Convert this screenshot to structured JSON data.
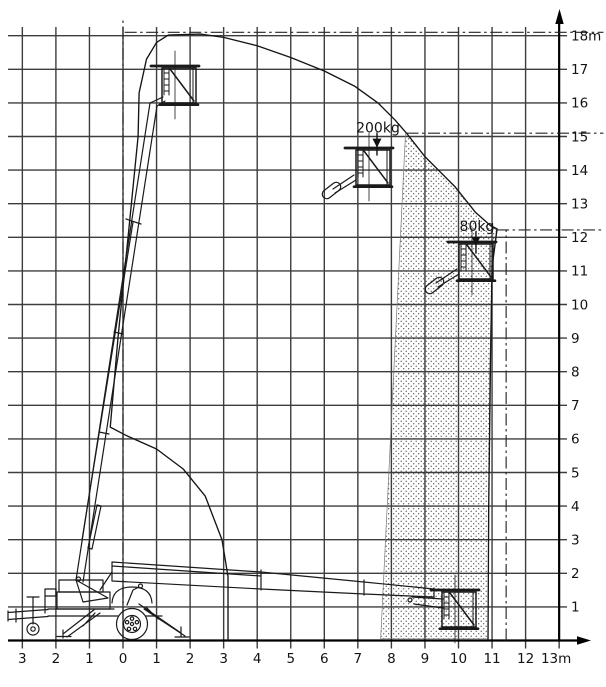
{
  "diagram": {
    "name": "aerial-work-platform-working-range-diagram",
    "x_axis": {
      "unit": "m",
      "values": [
        -3,
        -2,
        -1,
        0,
        1,
        2,
        3,
        4,
        5,
        6,
        7,
        8,
        9,
        10,
        11,
        12,
        13
      ],
      "labels": [
        "3",
        "2",
        "1",
        "0",
        "1",
        "2",
        "3",
        "4",
        "5",
        "6",
        "7",
        "8",
        "9",
        "10",
        "11",
        "12",
        "13m"
      ]
    },
    "y_axis": {
      "unit": "m",
      "values": [
        18,
        17,
        16,
        15,
        14,
        13,
        12,
        11,
        10,
        9,
        8,
        7,
        6,
        5,
        4,
        3,
        2,
        1
      ],
      "labels": [
        "18m",
        "17",
        "16",
        "15",
        "14",
        "13",
        "12",
        "11",
        "10",
        "9",
        "8",
        "7",
        "6",
        "5",
        "4",
        "3",
        "2",
        "1"
      ]
    },
    "load_limits": [
      {
        "label": "200kg",
        "x": 7.6,
        "text_y": 15.27,
        "arrow_top_y": 15.12,
        "arrow_tip_y": 14.67
      },
      {
        "label": "80kg",
        "x": 10.55,
        "text_y": 12.33,
        "arrow_top_y": 12.18,
        "arrow_tip_y": 11.75
      }
    ]
  },
  "chart_data": {
    "type": "area",
    "title": "Working envelope diagram with load limits (height m vs outreach m)",
    "xlim": [
      -3,
      13
    ],
    "ylim": [
      0,
      18
    ],
    "grid": "on",
    "envelope_m": [
      [
        3.13,
        0.02
      ],
      [
        3.13,
        1.9
      ],
      [
        2.95,
        3.0
      ],
      [
        2.45,
        4.3
      ],
      [
        1.8,
        5.1
      ],
      [
        1.0,
        5.7
      ],
      [
        0.1,
        6.1
      ],
      [
        -0.38,
        6.35
      ],
      [
        -0.15,
        9.0
      ],
      [
        0.15,
        12.0
      ],
      [
        0.35,
        14.0
      ],
      [
        0.45,
        15.0
      ],
      [
        0.48,
        16.3
      ],
      [
        0.7,
        17.3
      ],
      [
        1.0,
        17.8
      ],
      [
        1.35,
        18.02
      ],
      [
        2.3,
        18.05
      ],
      [
        3.0,
        17.95
      ],
      [
        4.0,
        17.7
      ],
      [
        5.0,
        17.35
      ],
      [
        6.0,
        16.95
      ],
      [
        6.9,
        16.5
      ],
      [
        7.6,
        16.0
      ],
      [
        8.1,
        15.5
      ],
      [
        8.45,
        15.1
      ],
      [
        9.0,
        14.4
      ],
      [
        9.5,
        13.9
      ],
      [
        9.9,
        13.5
      ],
      [
        10.5,
        12.75
      ],
      [
        10.95,
        12.35
      ],
      [
        11.15,
        12.25
      ],
      [
        11.0,
        11.1
      ],
      [
        10.95,
        8.0
      ],
      [
        10.9,
        4.0
      ],
      [
        10.88,
        0.05
      ]
    ],
    "restricted_zone_m": [
      [
        7.68,
        0.05
      ],
      [
        8.42,
        15.08
      ],
      [
        8.45,
        15.1
      ],
      [
        9.0,
        14.4
      ],
      [
        9.5,
        13.9
      ],
      [
        9.9,
        13.5
      ],
      [
        10.5,
        12.75
      ],
      [
        10.95,
        12.35
      ],
      [
        11.13,
        12.22
      ],
      [
        11.0,
        11.1
      ],
      [
        10.93,
        8.0
      ],
      [
        10.88,
        0.05
      ]
    ],
    "reference_lines": [
      {
        "orientation": "h",
        "y": 18.1,
        "x_start": 0.05,
        "x_end": 14.32,
        "style": "dash-dot"
      },
      {
        "orientation": "h",
        "y": 15.1,
        "x_start": 8.45,
        "x_end": 14.32,
        "style": "dash-dot"
      },
      {
        "orientation": "h",
        "y": 12.22,
        "x_start": 11.15,
        "x_end": 14.32,
        "style": "dash-dot"
      },
      {
        "orientation": "v",
        "x": 11.42,
        "y_start": 0.0,
        "y_end": 12.22,
        "style": "dash-dot"
      },
      {
        "orientation": "v",
        "x": 0.0,
        "y_start": 0.0,
        "y_end": 18.55,
        "style": "dash-dot"
      }
    ],
    "platform_positions": [
      {
        "name": "top-raised",
        "x_m": 1.7,
        "floor_y_m": 16.0
      },
      {
        "name": "mid-200kg",
        "x_m": 7.3,
        "floor_y_m": 13.6
      },
      {
        "name": "mid-80kg",
        "x_m": 10.4,
        "floor_y_m": 10.8
      },
      {
        "name": "low-extended",
        "x_m": 9.9,
        "floor_y_m": 0.2
      }
    ]
  }
}
